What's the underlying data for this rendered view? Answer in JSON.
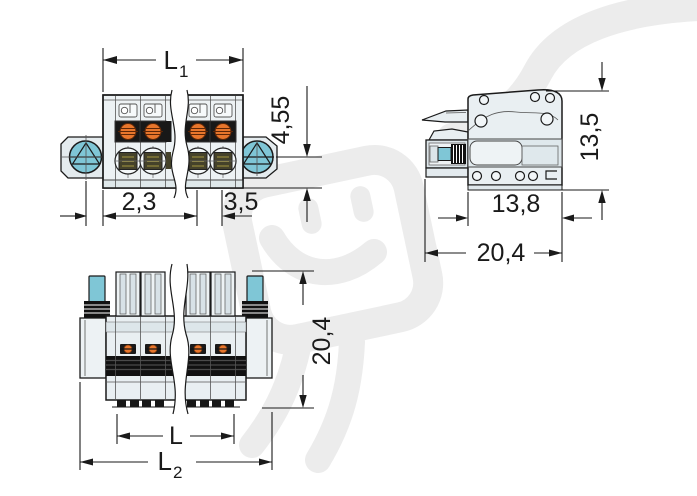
{
  "front_view": {
    "dim_length": {
      "base": "L",
      "sub": "1"
    },
    "dim_height": "4,55",
    "dim_flange_offset": "2,3",
    "dim_pitch": "3,5"
  },
  "side_view": {
    "dim_height": "13,5",
    "dim_depth_housing": "13,8",
    "dim_depth_total": "20,4"
  },
  "bottom_view": {
    "dim_height": "20,4",
    "dim_length_inner": "L",
    "dim_length_total": {
      "base": "L",
      "sub": "2"
    }
  },
  "colors": {
    "screw_teal": "#7fc6d6",
    "contact_orange": "#e8762c",
    "cage_olive": "#45422a",
    "housing_light": "#edf2f4",
    "band_black": "#111111",
    "line_dark": "#1a1a1a",
    "watermark_gray": "#ececec"
  }
}
